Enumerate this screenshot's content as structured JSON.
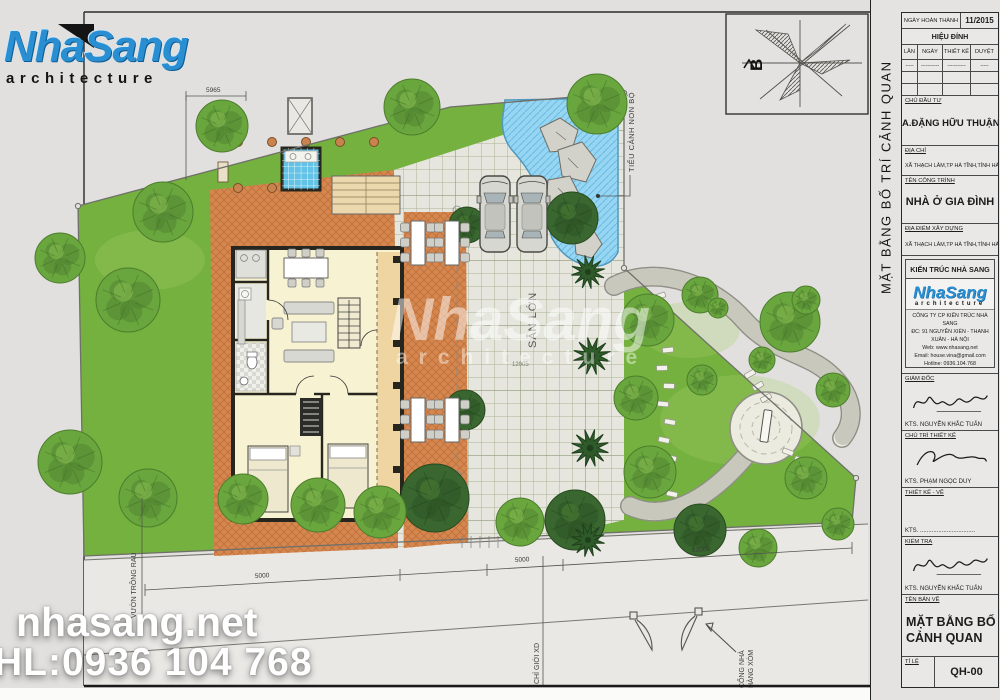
{
  "logo": {
    "name": "NhaSang",
    "sub": "architecture"
  },
  "watermark": {
    "site": "nhasang.net",
    "phone": "HL:0936 104 768",
    "center_name": "NhaSang",
    "center_sub": "architecture"
  },
  "north": {
    "label": "B"
  },
  "plan_labels": {
    "san_lon": "SÂN LỚN",
    "tieu_canh": "TIỂU CẢNH NON BỘ",
    "vuon_rau": "VƯỜN TRỒNG RAU",
    "chi_gioi": "CHỈ GIỚI XD",
    "cong_nha_1": "CỔNG NHÀ",
    "cong_nha_2": "HÀNG XÓM",
    "dim_top": "5965",
    "dim_5000a": "5000",
    "dim_5000b": "5000",
    "dim_10060": "10060",
    "dim_12005": "12005"
  },
  "titleblock": {
    "side_title": "MẶT BẰNG BỐ TRÍ CẢNH QUAN",
    "row_date_label": "NGÀY HOÀN THÀNH",
    "row_date_value": "11/2015",
    "revision_header": "HIỆU ĐÍNH",
    "rev_cols": [
      "LẦN",
      "NGÀY",
      "THIẾT KẾ",
      "DUYỆT"
    ],
    "rev_dashes": [
      "-----",
      "-----------",
      "-----------",
      "-----"
    ],
    "chu_dau_tu_label": "CHỦ ĐẦU TƯ",
    "chu_dau_tu": "A.ĐẶNG HỮU THUẬN",
    "dia_chi_label": "ĐỊA CHỈ",
    "dia_chi": "XÃ THẠCH LÂM,TP HÀ TĨNH,TỈNH HÀ TĨNH",
    "ten_cong_trinh_label": "TÊN CÔNG TRÌNH",
    "ten_cong_trinh": "NHÀ Ở GIA ĐÌNH",
    "dia_diem_label": "ĐỊA ĐIỂM XÂY DỰNG",
    "dia_diem": "XÃ THẠCH LÂM,TP HÀ TĨNH,TỈNH HÀ TĨNH",
    "firm_header": "KIẾN TRÚC NHÀ SANG",
    "firm_logo_name": "NhaSang",
    "firm_logo_sub": "architecture",
    "firm_lines": [
      "CÔNG TY CP KIẾN TRÚC NHÀ SANG",
      "ĐC: 91 NGUYỄN XIỂN - THANH XUÂN - HÀ NỘI",
      "Web: www.nhasang.net",
      "Email: house.vina@gmail.com",
      "Hotline: 0936.104.768"
    ],
    "giam_doc_label": "GIÁM ĐỐC",
    "giam_doc_name": "KTS. NGUYỄN KHẮC TUẤN",
    "chu_tri_label": "CHỦ TRÌ THIẾT KẾ",
    "chu_tri_name": "KTS. PHẠM NGỌC DUY",
    "thiet_ke_label": "THIẾT KẾ - VẼ",
    "thiet_ke_name": "KTS. .................................",
    "kiem_tra_label": "KIỂM TRA",
    "kiem_tra_name": "KTS. NGUYỄN KHẮC TUẤN",
    "ten_ban_ve_label": "TÊN BẢN VẼ",
    "ten_ban_ve_1": "MẶT BẰNG BỐ TRÍ",
    "ten_ban_ve_2": "CẢNH QUAN",
    "ti_le_label": "TỈ LỆ",
    "drawing_no": "QH-00"
  },
  "colors": {
    "lawn": "#74b13e",
    "patio": "#d6874e",
    "pool": "#97d6f2",
    "paving": "#e6e6df",
    "brand_blue": "#2a8fd2"
  },
  "trees": [
    [
      222,
      126,
      26,
      0
    ],
    [
      412,
      107,
      28,
      0
    ],
    [
      597,
      104,
      30,
      0
    ],
    [
      163,
      212,
      30,
      0
    ],
    [
      60,
      258,
      25,
      0
    ],
    [
      128,
      300,
      32,
      0
    ],
    [
      70,
      462,
      32,
      0
    ],
    [
      148,
      498,
      29,
      0
    ],
    [
      243,
      499,
      25,
      0
    ],
    [
      318,
      505,
      27,
      0
    ],
    [
      435,
      498,
      34,
      1
    ],
    [
      380,
      512,
      26,
      0
    ],
    [
      520,
      522,
      24,
      0
    ],
    [
      575,
      520,
      30,
      1
    ],
    [
      572,
      218,
      26,
      1
    ],
    [
      588,
      272,
      17,
      2
    ],
    [
      592,
      356,
      19,
      2
    ],
    [
      590,
      448,
      19,
      2
    ],
    [
      588,
      540,
      17,
      2
    ],
    [
      467,
      225,
      18,
      1
    ],
    [
      465,
      410,
      20,
      1
    ],
    [
      700,
      295,
      18,
      0
    ],
    [
      648,
      320,
      26,
      0
    ],
    [
      636,
      398,
      22,
      0
    ],
    [
      650,
      472,
      26,
      0
    ],
    [
      702,
      380,
      15,
      0
    ],
    [
      790,
      322,
      30,
      0
    ],
    [
      833,
      390,
      17,
      0
    ],
    [
      762,
      360,
      13,
      0
    ],
    [
      806,
      478,
      21,
      0
    ],
    [
      700,
      530,
      26,
      1
    ],
    [
      758,
      548,
      19,
      0
    ],
    [
      838,
      524,
      16,
      0
    ],
    [
      718,
      308,
      10,
      0
    ],
    [
      806,
      300,
      14,
      0
    ]
  ],
  "cars": [
    [
      480,
      176
    ],
    [
      517,
      176
    ]
  ],
  "tables": [
    [
      418,
      243
    ],
    [
      452,
      243
    ],
    [
      418,
      420
    ],
    [
      452,
      420
    ]
  ],
  "stones": [
    [
      660,
      296,
      -18
    ],
    [
      666,
      314,
      -14
    ],
    [
      661,
      332,
      -10
    ],
    [
      668,
      350,
      -6
    ],
    [
      662,
      368,
      -2
    ],
    [
      669,
      386,
      2
    ],
    [
      663,
      404,
      6
    ],
    [
      670,
      422,
      10
    ],
    [
      664,
      440,
      12
    ],
    [
      671,
      458,
      14
    ],
    [
      665,
      476,
      14
    ],
    [
      672,
      494,
      12
    ],
    [
      750,
      374,
      -30
    ],
    [
      758,
      386,
      -30
    ],
    [
      766,
      398,
      -30
    ],
    [
      788,
      452,
      20
    ],
    [
      800,
      460,
      20
    ],
    [
      812,
      468,
      20
    ]
  ]
}
